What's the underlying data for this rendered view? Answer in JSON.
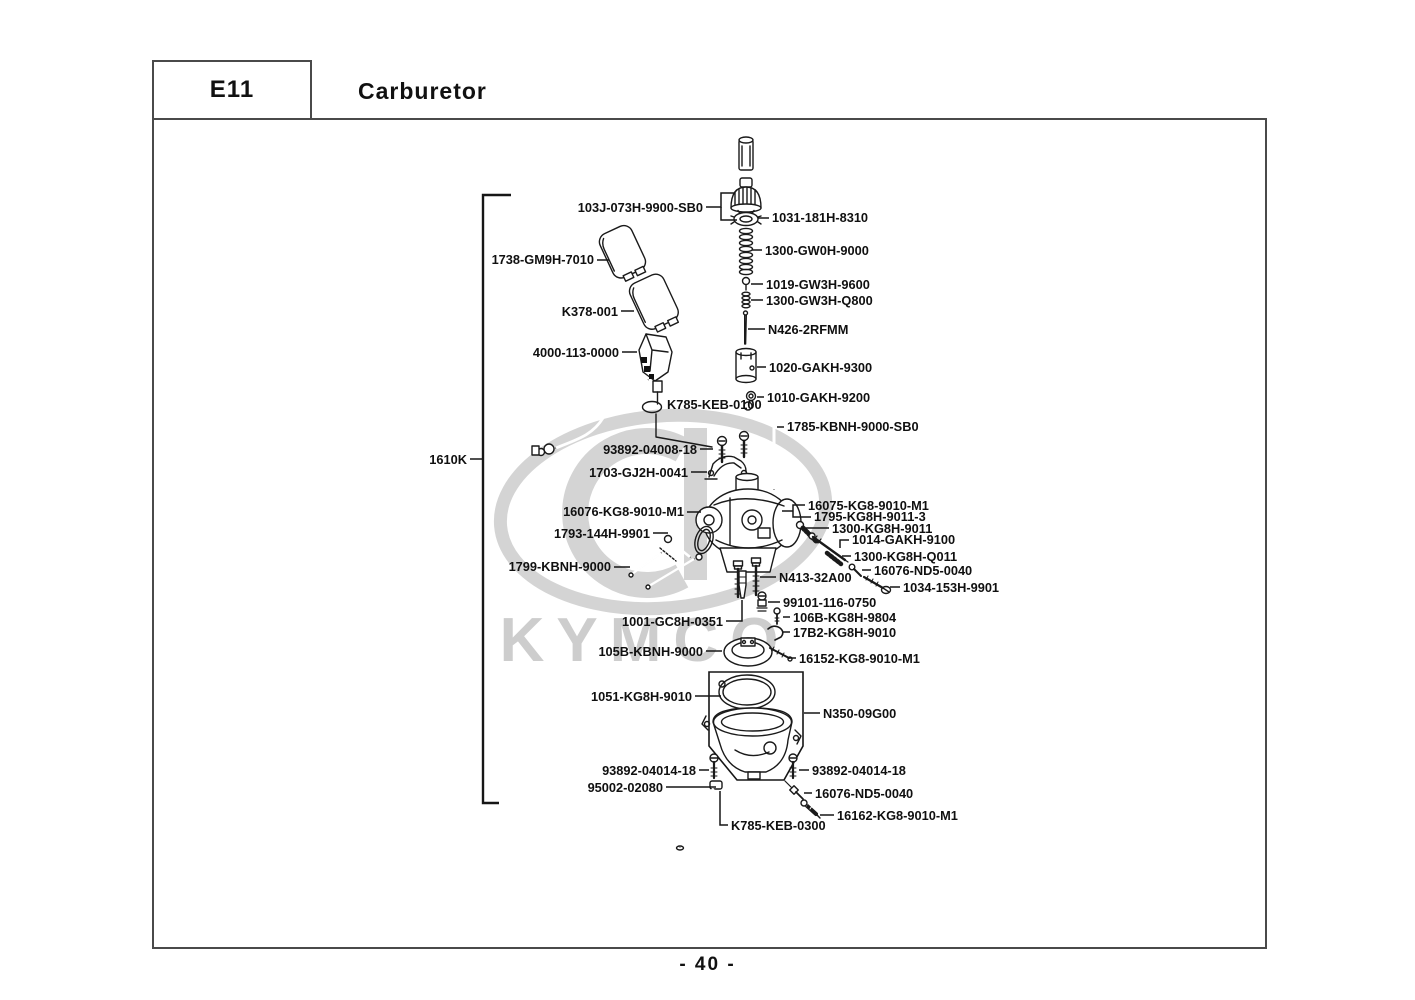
{
  "header": {
    "code": "E11",
    "title": "Carburetor"
  },
  "page_number": "- 40 -",
  "watermark": {
    "text": "KYMCO",
    "color": "#cdcdcd"
  },
  "assembly_group_label": "1610K",
  "diagram": {
    "parts": [
      {
        "label": "103J-073H-9900-SB0",
        "x": 703,
        "y": 212,
        "align": "end",
        "leaders": [
          [
            [
              706,
              207
            ],
            [
              721,
              207
            ],
            [
              721,
              193
            ],
            [
              734,
              193
            ]
          ],
          [
            [
              721,
              207
            ],
            [
              721,
              220
            ],
            [
              737,
              220
            ]
          ]
        ]
      },
      {
        "label": "1031-181H-8310",
        "x": 772,
        "y": 222,
        "align": "start",
        "leaders": [
          [
            [
              769,
              218
            ],
            [
              758,
              218
            ]
          ]
        ]
      },
      {
        "label": "1300-GW0H-9000",
        "x": 765,
        "y": 255,
        "align": "start",
        "leaders": [
          [
            [
              762,
              250
            ],
            [
              752,
              250
            ]
          ]
        ]
      },
      {
        "label": "1019-GW3H-9600",
        "x": 766,
        "y": 289,
        "align": "start",
        "leaders": [
          [
            [
              763,
              284
            ],
            [
              751,
              284
            ]
          ]
        ]
      },
      {
        "label": "1300-GW3H-Q800",
        "x": 766,
        "y": 305,
        "align": "start",
        "leaders": [
          [
            [
              763,
              300
            ],
            [
              751,
              300
            ]
          ]
        ]
      },
      {
        "label": "N426-2RFMM",
        "x": 768,
        "y": 334,
        "align": "start",
        "leaders": [
          [
            [
              765,
              329
            ],
            [
              748,
              329
            ]
          ]
        ]
      },
      {
        "label": "1020-GAKH-9300",
        "x": 769,
        "y": 372,
        "align": "start",
        "leaders": [
          [
            [
              766,
              367
            ],
            [
              757,
              367
            ]
          ]
        ]
      },
      {
        "label": "1010-GAKH-9200",
        "x": 767,
        "y": 402,
        "align": "start",
        "leaders": [
          [
            [
              764,
              397
            ],
            [
              757,
              397
            ]
          ]
        ]
      },
      {
        "label": "1738-GM9H-7010",
        "x": 594,
        "y": 264,
        "align": "end",
        "leaders": [
          [
            [
              597,
              260
            ],
            [
              609,
              260
            ]
          ]
        ]
      },
      {
        "label": "K378-001",
        "x": 618,
        "y": 316,
        "align": "end",
        "leaders": [
          [
            [
              621,
              311
            ],
            [
              634,
              311
            ]
          ]
        ]
      },
      {
        "label": "4000-113-0000",
        "x": 619,
        "y": 357,
        "align": "end",
        "leaders": [
          [
            [
              622,
              352
            ],
            [
              637,
              352
            ]
          ]
        ]
      },
      {
        "label": "K785-KEB-0100",
        "x": 667,
        "y": 409,
        "align": "start",
        "size": 10.5,
        "leaders": []
      },
      {
        "label": "1785-KBNH-9000-SB0",
        "x": 787,
        "y": 431,
        "align": "start",
        "leaders": [
          [
            [
              784,
              427
            ],
            [
              777,
              427
            ]
          ]
        ]
      },
      {
        "label": "93892-04008-18",
        "x": 697,
        "y": 454,
        "align": "end",
        "leaders": [
          [
            [
              700,
              449
            ],
            [
              713,
              449
            ]
          ]
        ]
      },
      {
        "label": "1703-GJ2H-0041",
        "x": 688,
        "y": 477,
        "align": "end",
        "leaders": [
          [
            [
              691,
              472
            ],
            [
              707,
              472
            ]
          ]
        ]
      },
      {
        "label": "16075-KG8-9010-M1",
        "x": 808,
        "y": 510,
        "align": "start",
        "leaders": [
          [
            [
              805,
              505
            ],
            [
              793,
              505
            ],
            [
              793,
              517
            ],
            [
              811,
              517
            ]
          ],
          [
            [
              793,
              511
            ],
            [
              782,
              511
            ]
          ]
        ]
      },
      {
        "label": "1795-KG8H-9011-3",
        "x": 814,
        "y": 521,
        "align": "start",
        "leaders": []
      },
      {
        "label": "1300-KG8H-9011",
        "x": 832,
        "y": 533,
        "align": "start",
        "leaders": [
          [
            [
              829,
              528
            ],
            [
              806,
              528
            ]
          ]
        ]
      },
      {
        "label": "1014-GAKH-9100",
        "x": 852,
        "y": 544,
        "align": "start",
        "leaders": [
          [
            [
              849,
              540
            ],
            [
              840,
              540
            ],
            [
              840,
              548
            ]
          ]
        ]
      },
      {
        "label": "1300-KG8H-Q011",
        "x": 854,
        "y": 561,
        "align": "start",
        "leaders": [
          [
            [
              851,
              556
            ],
            [
              842,
              556
            ]
          ]
        ]
      },
      {
        "label": "16076-ND5-0040",
        "x": 874,
        "y": 575,
        "align": "start",
        "leaders": [
          [
            [
              871,
              570
            ],
            [
              862,
              570
            ]
          ]
        ]
      },
      {
        "label": "1034-153H-9901",
        "x": 903,
        "y": 592,
        "align": "start",
        "leaders": [
          [
            [
              900,
              587
            ],
            [
              890,
              587
            ]
          ]
        ]
      },
      {
        "label": "16076-KG8-9010-M1",
        "x": 684,
        "y": 516,
        "align": "end",
        "leaders": [
          [
            [
              687,
              512
            ],
            [
              701,
              512
            ]
          ]
        ]
      },
      {
        "label": "1793-144H-9901",
        "x": 650,
        "y": 538,
        "align": "end",
        "leaders": [
          [
            [
              653,
              533
            ],
            [
              668,
              533
            ]
          ]
        ]
      },
      {
        "label": "1799-KBNH-9000",
        "x": 611,
        "y": 571,
        "align": "end",
        "leaders": [
          [
            [
              614,
              567
            ],
            [
              630,
              567
            ]
          ]
        ]
      },
      {
        "label": "N413-32A00",
        "x": 779,
        "y": 582,
        "align": "start",
        "leaders": [
          [
            [
              776,
              577
            ],
            [
              760,
              577
            ]
          ]
        ]
      },
      {
        "label": "99101-116-0750",
        "x": 783,
        "y": 607,
        "align": "start",
        "leaders": [
          [
            [
              780,
              602
            ],
            [
              768,
              602
            ]
          ]
        ]
      },
      {
        "label": "1001-GC8H-0351",
        "x": 723,
        "y": 626,
        "align": "end",
        "leaders": [
          [
            [
              726,
              621
            ],
            [
              742,
              621
            ],
            [
              742,
              600
            ]
          ]
        ]
      },
      {
        "label": "106B-KG8H-9804",
        "x": 793,
        "y": 622,
        "align": "start",
        "leaders": [
          [
            [
              790,
              617
            ],
            [
              783,
              617
            ]
          ]
        ]
      },
      {
        "label": "17B2-KG8H-9010",
        "x": 793,
        "y": 637,
        "align": "start",
        "leaders": [
          [
            [
              790,
              632
            ],
            [
              783,
              632
            ]
          ]
        ]
      },
      {
        "label": "105B-KBNH-9000",
        "x": 703,
        "y": 656,
        "align": "end",
        "leaders": [
          [
            [
              706,
              651
            ],
            [
              722,
              651
            ]
          ]
        ]
      },
      {
        "label": "16152-KG8-9010-M1",
        "x": 799,
        "y": 663,
        "align": "start",
        "leaders": [
          [
            [
              796,
              658
            ],
            [
              788,
              658
            ]
          ]
        ]
      },
      {
        "label": "1051-KG8H-9010",
        "x": 692,
        "y": 701,
        "align": "end",
        "leaders": [
          [
            [
              695,
              696
            ],
            [
              721,
              696
            ]
          ]
        ]
      },
      {
        "label": "N350-09G00",
        "x": 823,
        "y": 718,
        "align": "start",
        "leaders": [
          [
            [
              820,
              713
            ],
            [
              804,
              713
            ]
          ]
        ]
      },
      {
        "label": "93892-04014-18",
        "x": 696,
        "y": 775,
        "align": "end",
        "leaders": [
          [
            [
              699,
              770
            ],
            [
              709,
              770
            ]
          ]
        ]
      },
      {
        "label": "93892-04014-18",
        "x": 812,
        "y": 775,
        "align": "start",
        "leaders": [
          [
            [
              809,
              770
            ],
            [
              799,
              770
            ]
          ]
        ]
      },
      {
        "label": "95002-02080",
        "x": 663,
        "y": 792,
        "align": "end",
        "leaders": [
          [
            [
              666,
              787
            ],
            [
              716,
              787
            ]
          ]
        ]
      },
      {
        "label": "16076-ND5-0040",
        "x": 815,
        "y": 798,
        "align": "start",
        "leaders": [
          [
            [
              812,
              793
            ],
            [
              804,
              793
            ]
          ]
        ]
      },
      {
        "label": "16162-KG8-9010-M1",
        "x": 837,
        "y": 820,
        "align": "start",
        "leaders": [
          [
            [
              834,
              815
            ],
            [
              820,
              815
            ]
          ]
        ]
      },
      {
        "label": "K785-KEB-0300",
        "x": 731,
        "y": 830,
        "align": "start",
        "leaders": [
          [
            [
              728,
              825
            ],
            [
              720,
              825
            ],
            [
              720,
              791
            ]
          ]
        ]
      },
      {
        "label": "1610K",
        "x": 467,
        "y": 464,
        "align": "end",
        "leaders": [
          [
            [
              470,
              459
            ],
            [
              483,
              459
            ]
          ]
        ]
      }
    ]
  }
}
